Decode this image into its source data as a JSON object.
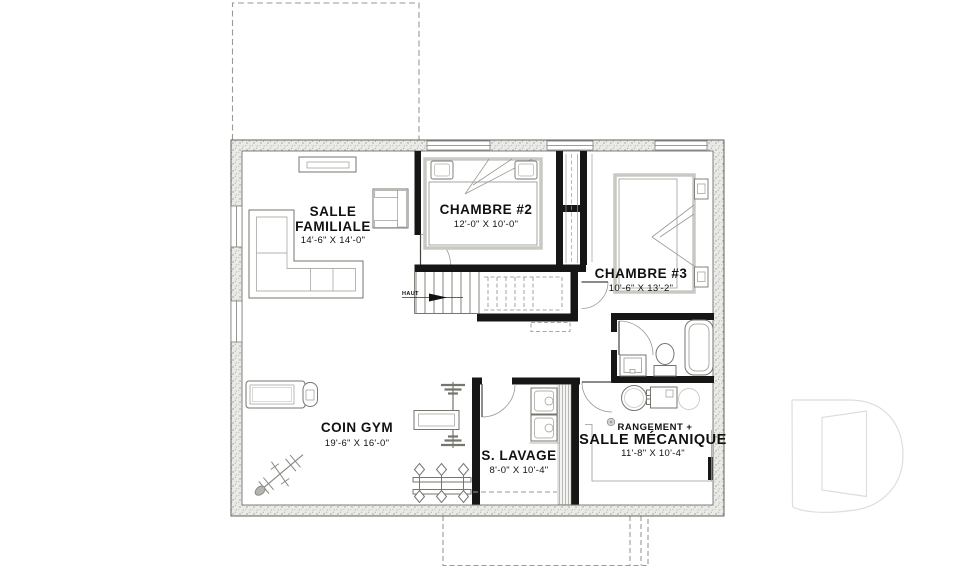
{
  "floorplan": {
    "rooms": [
      {
        "line1": "SALLE",
        "line2": "FAMILIALE",
        "dims": "14'-6\" X 14'-0\""
      },
      {
        "line1": "CHAMBRE #2",
        "dims": "12'-0\" X 10'-0\""
      },
      {
        "line1": "CHAMBRE #3",
        "dims": "10'-6\" X 13'-2\""
      },
      {
        "line1": "COIN GYM",
        "dims": "19'-6\" X 16'-0\""
      },
      {
        "line1": "S. LAVAGE",
        "dims": "8'-0\" X 10'-4\""
      },
      {
        "line1": "RANGEMENT +",
        "line2": "SALLE MÉCANIQUE",
        "dims": "11'-8\" X 10'-4\""
      }
    ],
    "stairs": {
      "direction_label": "HAUT"
    },
    "watermark": {
      "icon": "drummond-d-logo"
    },
    "colors": {
      "walls": "#161616",
      "foundation_fill": "#e9e9e6",
      "furniture_line": "#76766f",
      "light_line": "#9a9a94",
      "watermark_line": "#dedede",
      "background": "#ffffff"
    }
  }
}
